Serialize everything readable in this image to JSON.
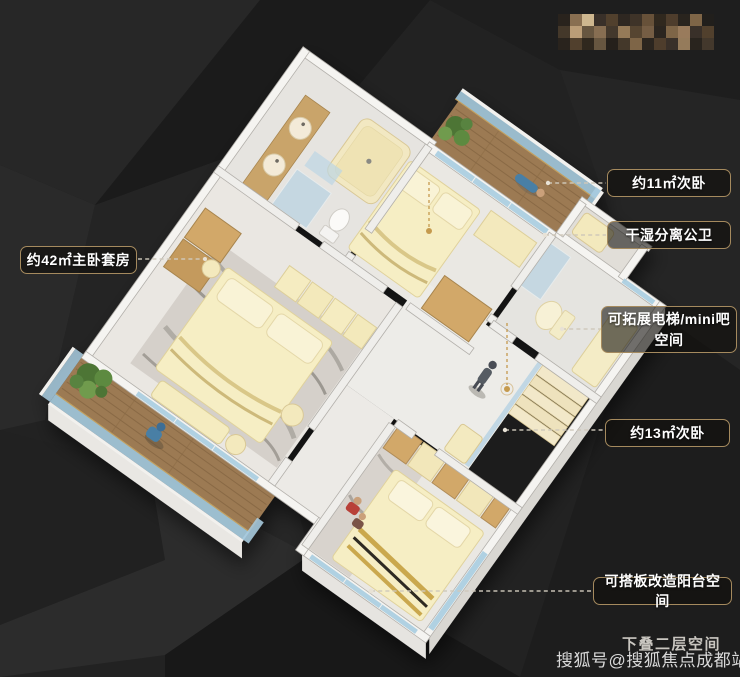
{
  "labels": {
    "master_suite": "约42㎡主卧套房",
    "bedroom_11": "约11㎡次卧",
    "public_bath": "干湿分离公卫",
    "minibar": "可拓展电梯/mini吧空间",
    "bedroom_13": "约13㎡次卧",
    "balcony": "可搭板改造阳台空间"
  },
  "captions": {
    "floor_note": "下叠二层空间",
    "watermark": "搜狐号@搜狐焦点成都站"
  },
  "colors": {
    "accent_gold": "#a58a5e",
    "label_text": "#ffffff",
    "furniture_cream": "#f3e9c0",
    "wood_cabinet": "#cda669",
    "deck_wood": "#9c7a52",
    "glass_blue": "#a9cde0",
    "background": "#222222",
    "leader_dash": "#cfc8ba",
    "anchor_gold": "#c59a4e"
  }
}
